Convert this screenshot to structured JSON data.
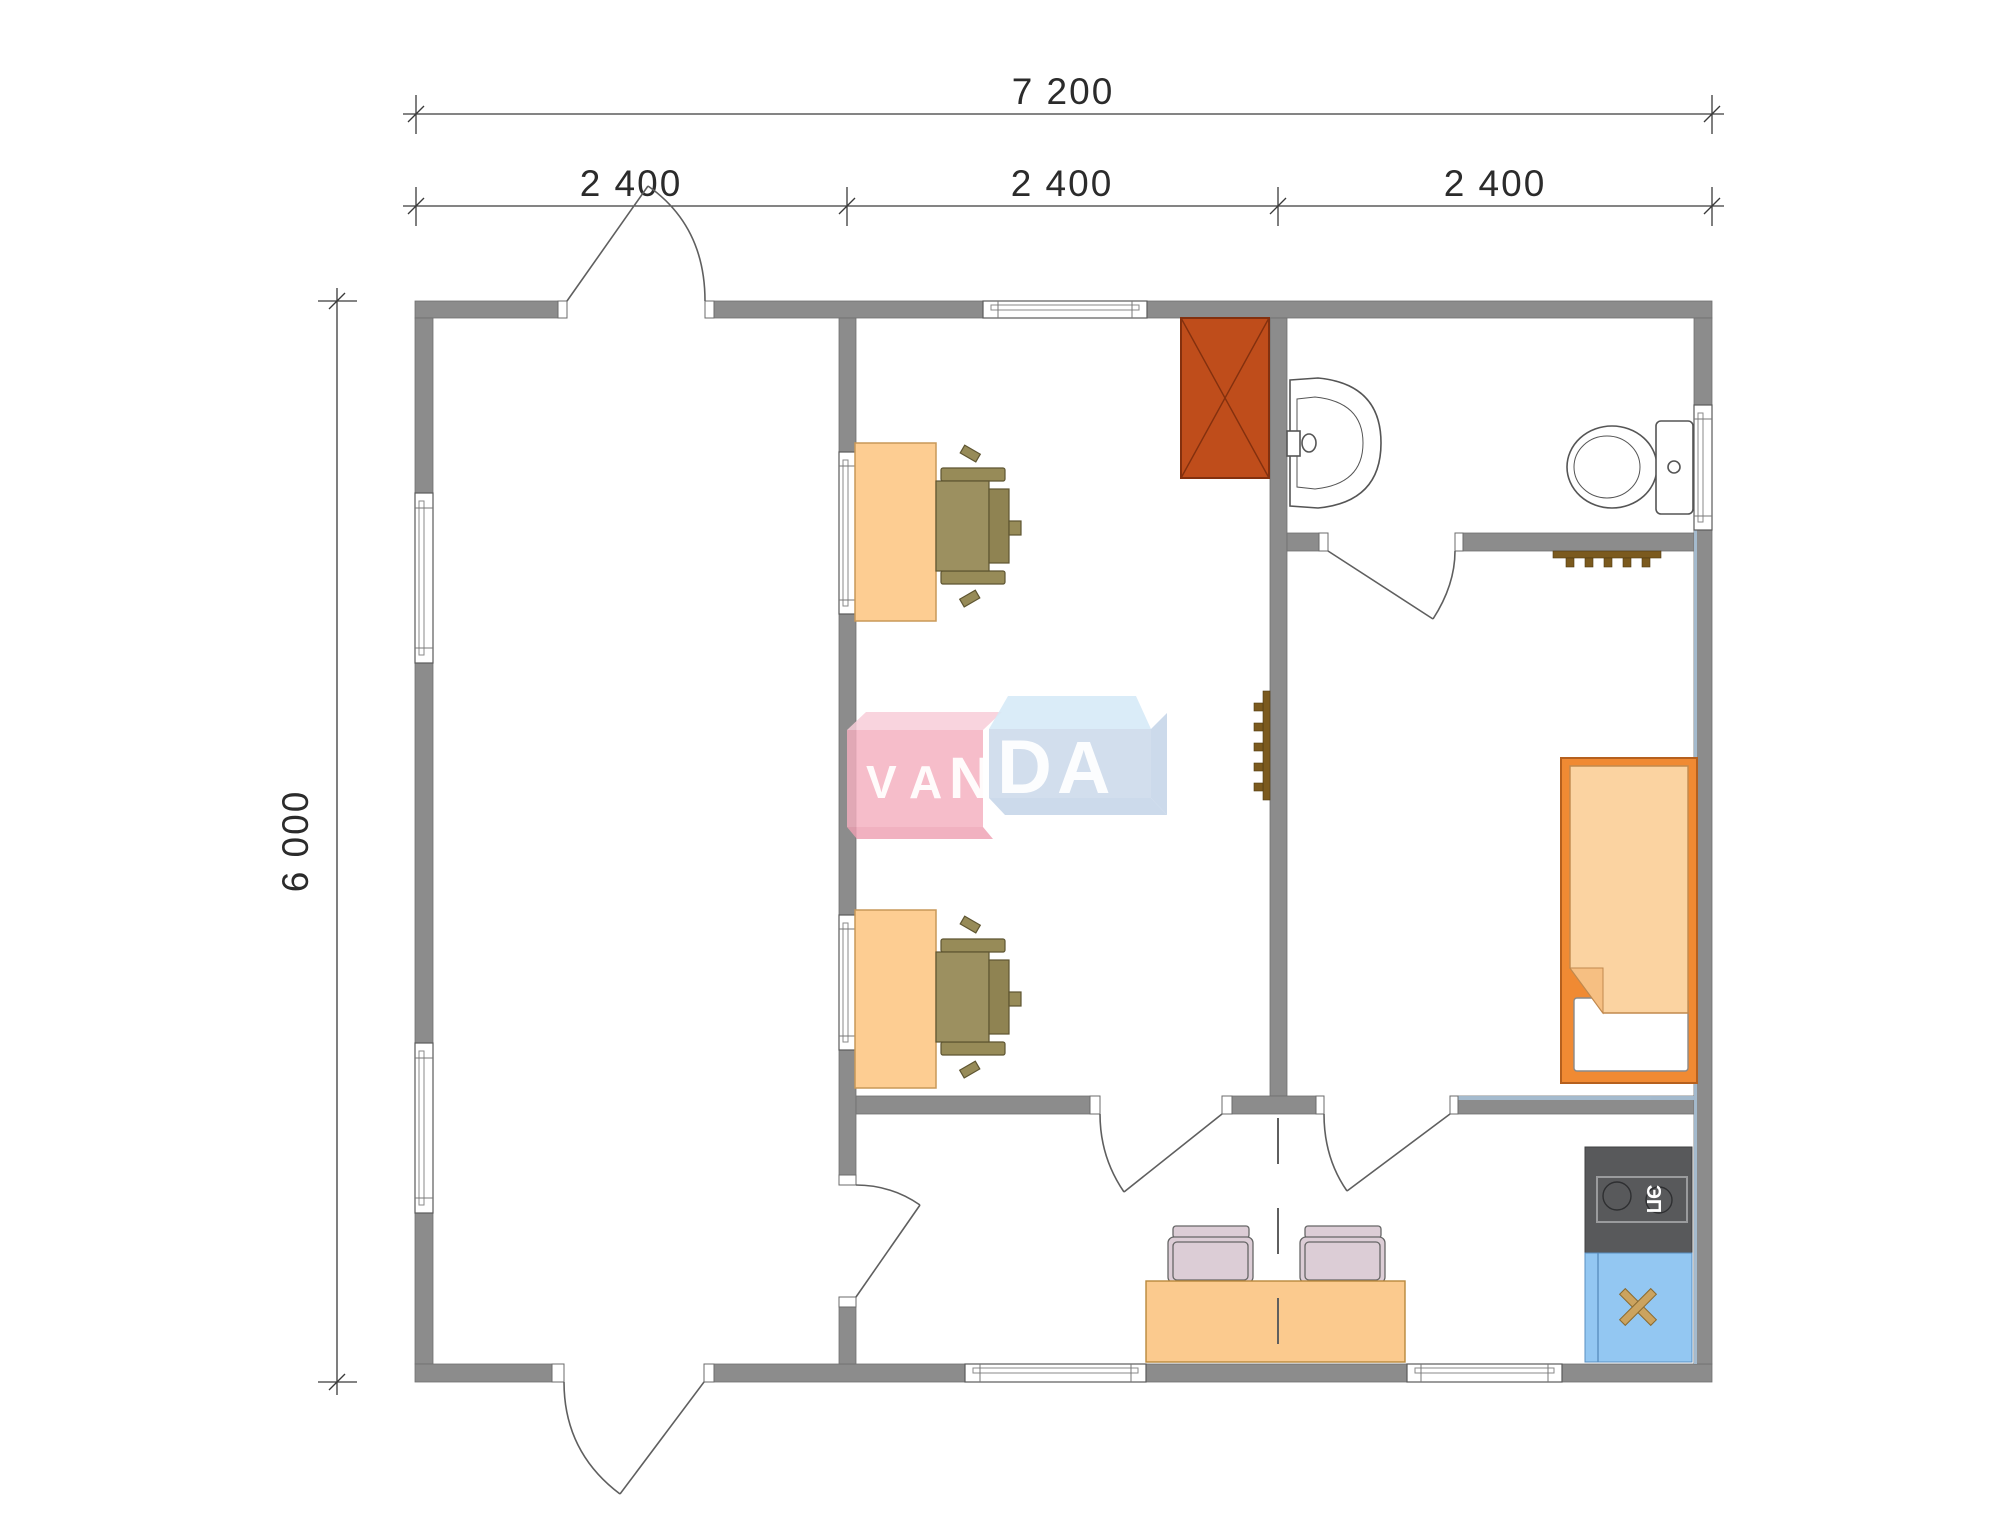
{
  "page": {
    "background": "#ffffff",
    "type": "architectural-floor-plan"
  },
  "dimensions": {
    "total_width_label": "7 200",
    "segment_labels": [
      "2 400",
      "2 400",
      "2 400"
    ],
    "total_height_label": "6 000"
  },
  "watermark": {
    "text": "VANDA",
    "letters": [
      "V",
      "A",
      "N",
      "D",
      "A"
    ]
  },
  "appliances": {
    "stove_label": "ЭП"
  },
  "colors": {
    "wall": "#8c8c8c",
    "wall_highlight": "#a9c3d9",
    "wardrobe": "#bf4d1b",
    "wardrobe_line": "#83300e",
    "desk": "#fdcd92",
    "table": "#fbca8e",
    "office_chair": "#9c9060",
    "dining_chair": "#dccdd6",
    "bed_frame": "#f08a33",
    "bed_blanket": "#fbd3a1",
    "bed_fold": "#f6bf82",
    "stove": "#58595b",
    "kitchen_sink": "#93c7f2",
    "sink_cross": "#cba35f",
    "hooks": "#7b5a1e",
    "logo_pink_front": "#f4afbe",
    "logo_pink_top": "#f8cdd8",
    "logo_pink_bottom": "#eea0b2",
    "logo_blue_front": "#cad8ea",
    "logo_blue_top": "#d5e9f7",
    "logo_blue_bottom": "#c3d3e8",
    "dimension_ink": "#3a3a3a"
  },
  "icons": {
    "furniture": [
      "wardrobe-icon",
      "desk-icon",
      "office-chair-icon",
      "coat-hooks-icon",
      "washbasin-icon",
      "toilet-icon",
      "bed-icon",
      "dining-table-icon",
      "dining-chair-icon",
      "stove-icon",
      "kitchen-sink-icon",
      "door-swing-icon",
      "window-icon"
    ]
  }
}
